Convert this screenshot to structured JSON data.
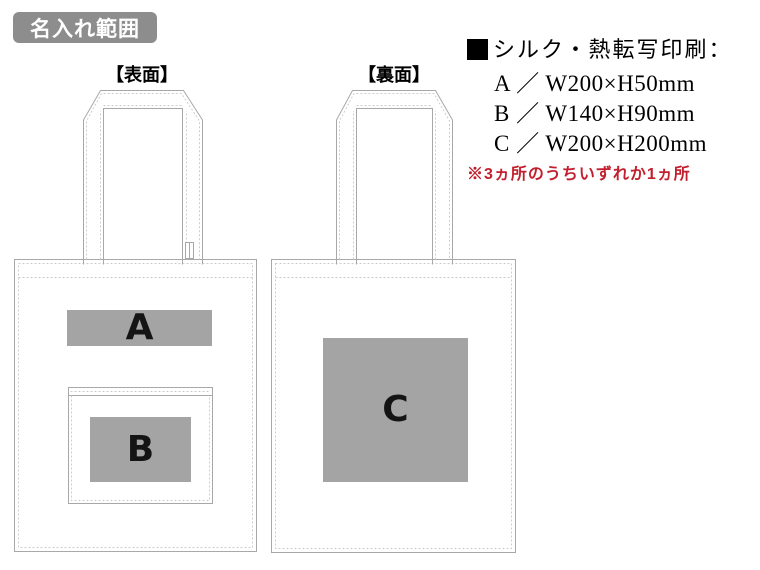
{
  "badge": {
    "label": "名入れ範囲"
  },
  "colors": {
    "badge_bg": "#8d8d8d",
    "badge_text": "#ffffff",
    "print_area_fill": "#a4a4a4",
    "print_area_label": "#141414",
    "bag_outline": "#a8a8a8",
    "stitch_line": "#cdcdcd",
    "note_red": "#c2202e"
  },
  "front_bag": {
    "label": "【表面】",
    "print_areas": [
      {
        "id": "A"
      },
      {
        "id": "B"
      }
    ]
  },
  "back_bag": {
    "label": "【裏面】",
    "print_areas": [
      {
        "id": "C"
      }
    ]
  },
  "spec": {
    "bullet": "■",
    "heading": "シルク・熱転写印刷：",
    "items": [
      "A ／ W200×H50mm",
      "B ／ W140×H90mm",
      "C ／ W200×H200mm"
    ],
    "note": "※3ヵ所のうちいずれか1ヵ所"
  }
}
